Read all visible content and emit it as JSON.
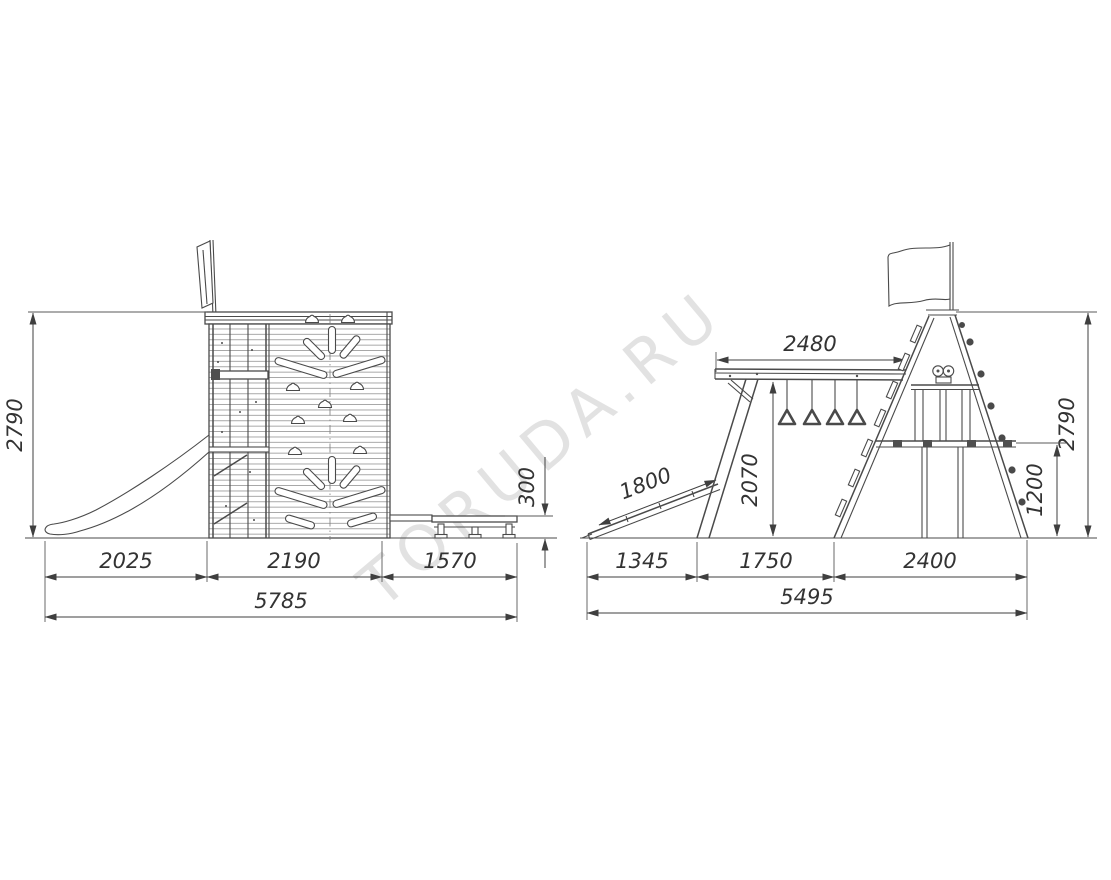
{
  "watermark": "TORUDA.RU",
  "side": {
    "height": "2790",
    "slide": "2025",
    "tower": "2190",
    "bench": "1570",
    "total": "5785",
    "bench_height": "300"
  },
  "front": {
    "beam": "2480",
    "height": "2790",
    "ramp": "1800",
    "beam_height": "2070",
    "platform": "1200",
    "ramp_base": "1345",
    "mid": "1750",
    "base": "2400",
    "total": "5495"
  }
}
